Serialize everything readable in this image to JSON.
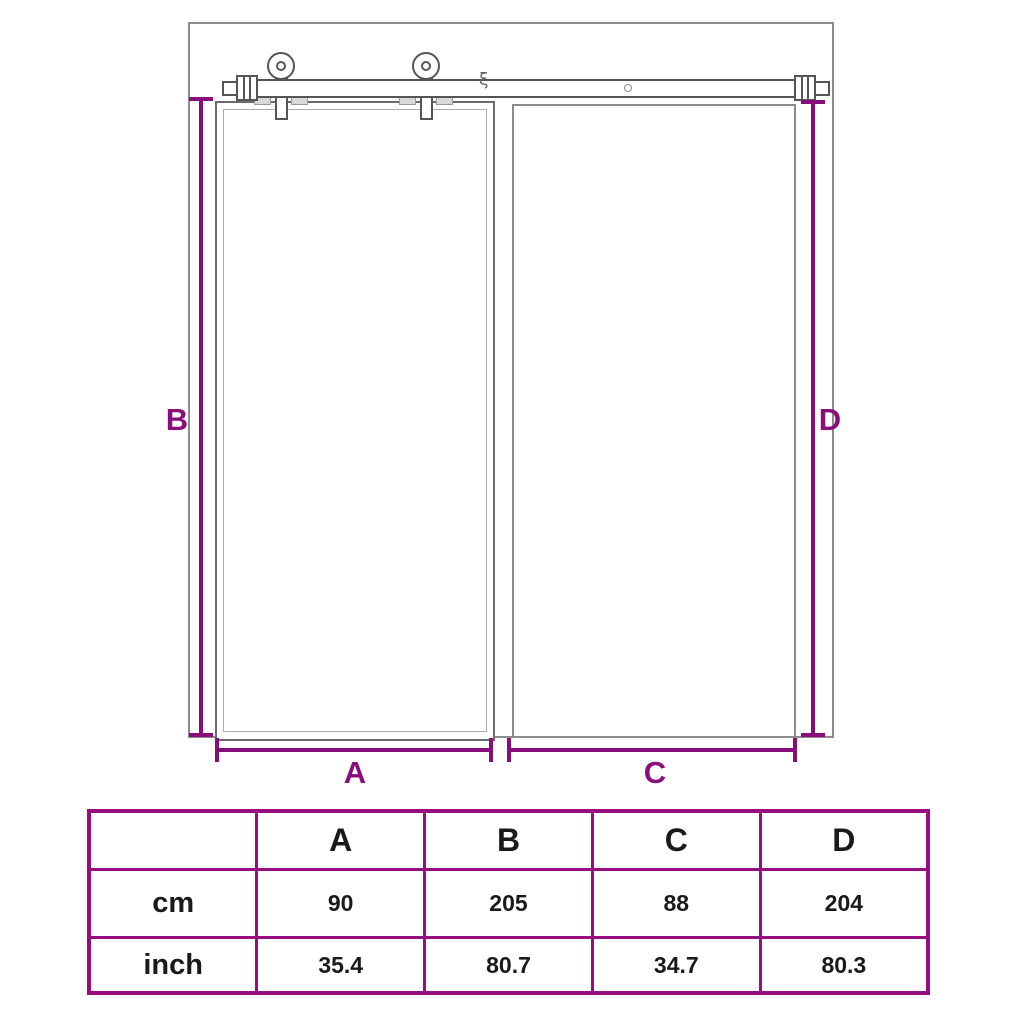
{
  "colors": {
    "outline": "#8c8c8c",
    "door": "#6b6b6b",
    "hardware": "#555555",
    "dimension": "#8a0d7c",
    "table_border": "#970d7f",
    "text": "#1a1a1a"
  },
  "diagram": {
    "labels": {
      "a": "A",
      "b": "B",
      "c": "C",
      "d": "D"
    },
    "break_mark": "ξ"
  },
  "table": {
    "headers": [
      "",
      "A",
      "B",
      "C",
      "D"
    ],
    "rows": [
      {
        "label": "cm",
        "values": [
          "90",
          "205",
          "88",
          "204"
        ]
      },
      {
        "label": "inch",
        "values": [
          "35.4",
          "80.7",
          "34.7",
          "80.3"
        ]
      }
    ]
  }
}
